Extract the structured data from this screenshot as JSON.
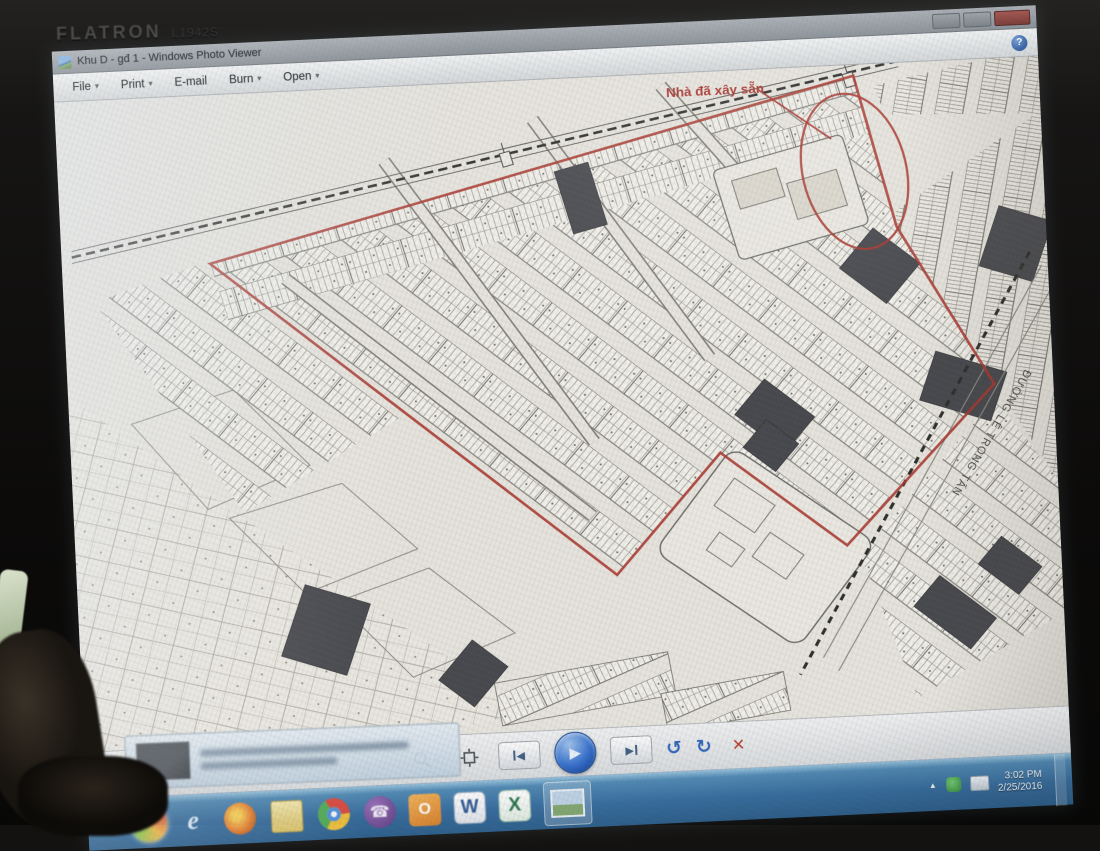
{
  "monitor": {
    "brand": "FLATRON",
    "model": "L1942S"
  },
  "photo_viewer": {
    "title": "Khu D - gđ 1 - Windows Photo Viewer",
    "menu": {
      "file": "File",
      "print": "Print",
      "email": "E-mail",
      "burn": "Burn",
      "open": "Open",
      "dropdown_caret": "▾",
      "help": "?"
    }
  },
  "map": {
    "annotation_built_houses": "Nhà đã xây sẵn",
    "road_name": "ĐƯỜNG LÊ TRỌNG TẤN",
    "boundary_color": "#b23228",
    "paper_color": "#e9e6de"
  },
  "viewer_controls": {
    "previous": "◀",
    "play": "▶",
    "next": "▶",
    "rotate_ccw": "↺",
    "rotate_cw": "↻",
    "delete": "✕",
    "zoom_caret": "▾"
  },
  "taskbar": {
    "icons": {
      "ie": "e",
      "outlook": "O",
      "word": "W",
      "excel": "X",
      "viber": "☎"
    },
    "tray": {
      "expand_arrow": "▲",
      "time": "3:02 PM",
      "date": "2/25/2016"
    }
  }
}
